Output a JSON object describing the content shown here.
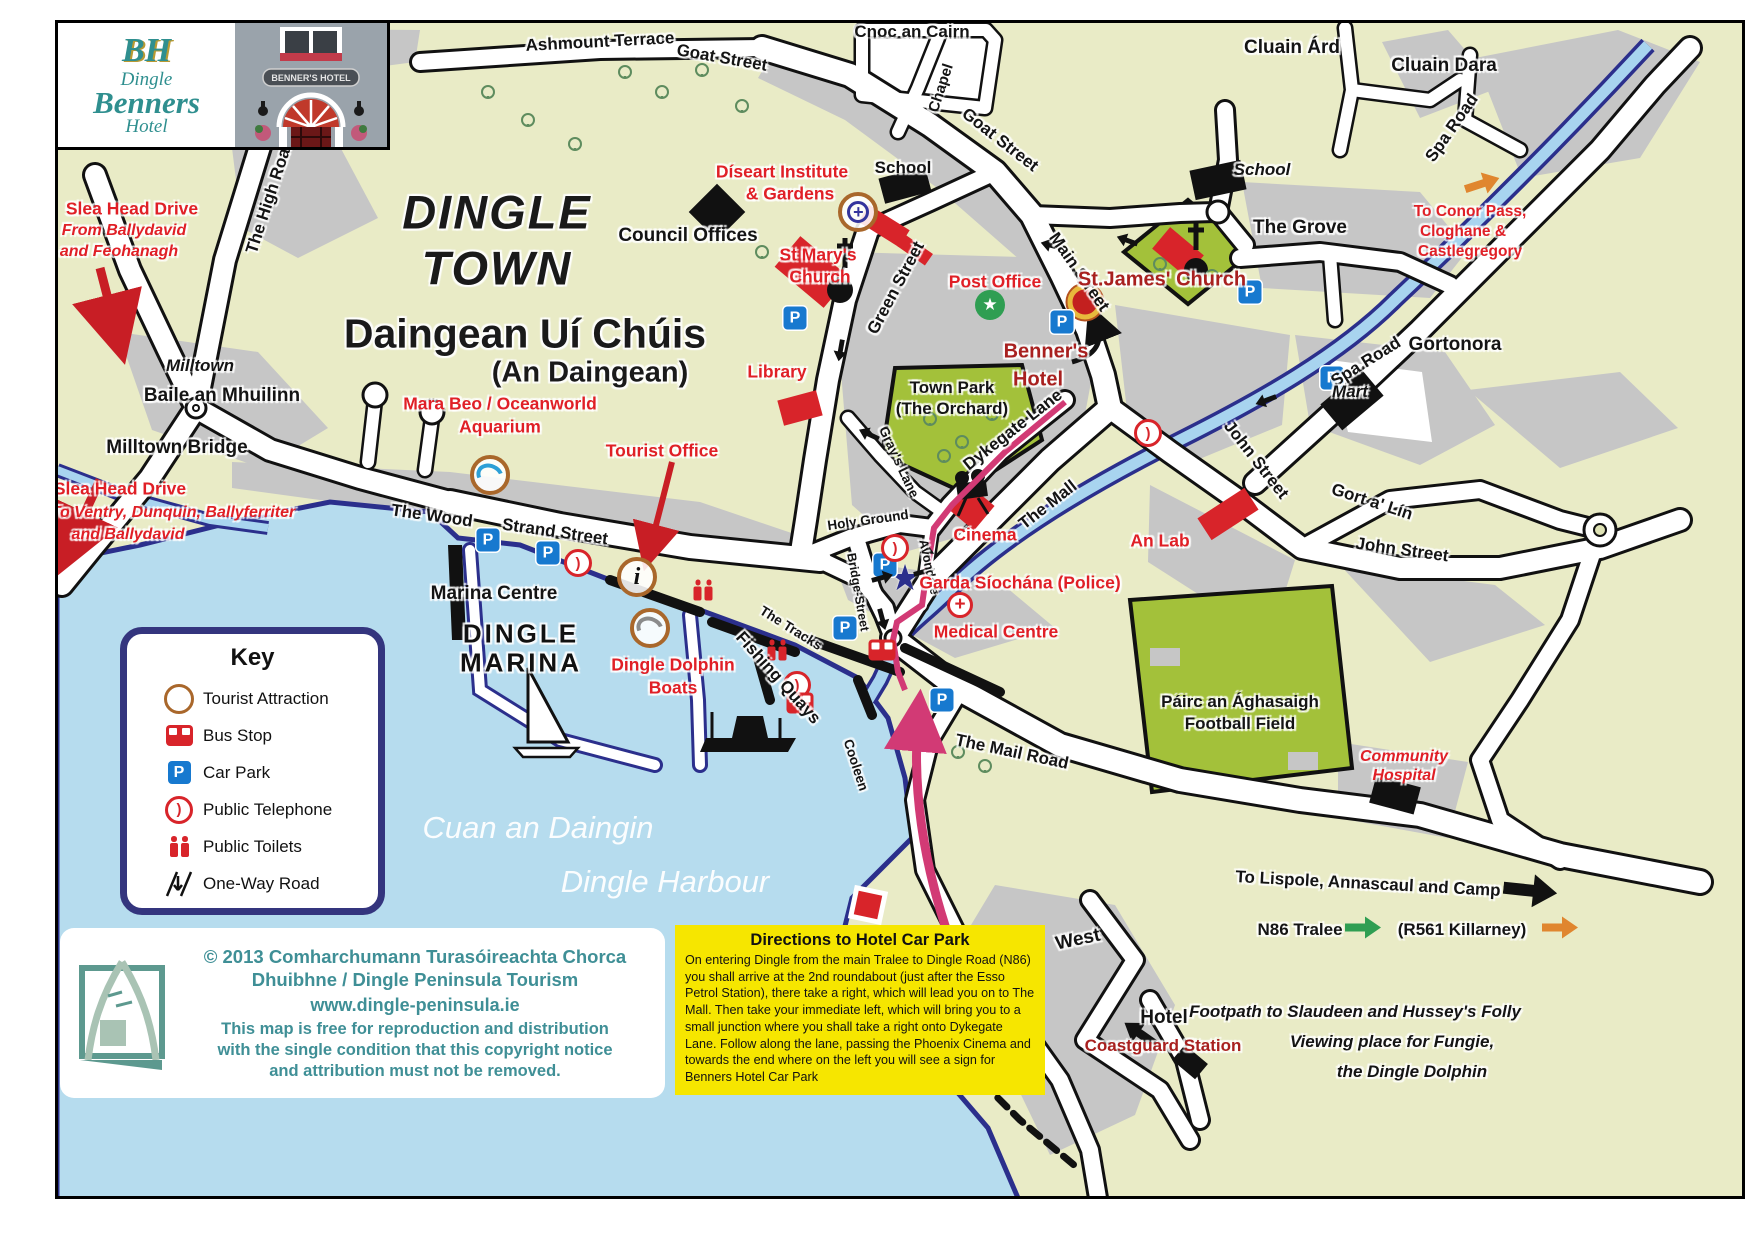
{
  "logo": {
    "monogram": "BH",
    "name_line1": "Dingle",
    "name_line2": "Benners",
    "name_line3": "Hotel",
    "photo_sign": "BENNER'S HOTEL"
  },
  "key": {
    "heading": "Key",
    "items": [
      {
        "icon": "tourist-attraction-icon",
        "label": "Tourist Attraction"
      },
      {
        "icon": "bus-stop-icon",
        "label": "Bus Stop"
      },
      {
        "icon": "car-park-icon",
        "label": "Car Park"
      },
      {
        "icon": "public-telephone-icon",
        "label": "Public Telephone"
      },
      {
        "icon": "public-toilets-icon",
        "label": "Public Toilets"
      },
      {
        "icon": "one-way-road-icon",
        "label": "One-Way Road"
      }
    ]
  },
  "copyright": {
    "line1": "© 2013 Comharchumann Turasóireachta Chorca",
    "line2": "Dhuibhne / Dingle Peninsula Tourism",
    "website": "www.dingle-peninsula.ie",
    "note1": "This map is free for reproduction and distribution",
    "note2": "with the single condition that this copyright notice",
    "note3": "and attribution must not be removed."
  },
  "directions": {
    "title": "Directions to Hotel Car Park",
    "body": "On entering Dingle from the main Tralee to Dingle Road (N86) you shall arrive at the 2nd roundabout (just after the Esso Petrol Station), there take a right, which will lead you on to The Mall. Then take your immediate left, which will bring you to a small junction where you shall take a right onto Dykegate Lane. Follow along the lane, passing the Phoenix Cinema and towards the end where on the left you will see a sign for Benners Hotel Car Park"
  },
  "colors": {
    "land": "#e9ebc6",
    "urban": "#c6c6c6",
    "water": "#b6dcee",
    "coast": "#2b2f8c",
    "road": "#ffffff",
    "park": "#a3c13a",
    "poi_red": "#e01f26",
    "dark_red": "#a8201f",
    "route_magenta": "#d23a75",
    "carpark_blue": "#1779cf",
    "attraction_ring": "#a9672b",
    "teal": "#3f8f96",
    "directions_yellow": "#f6e600",
    "arrow_green": "#2f9e52",
    "arrow_orange": "#e0862f"
  },
  "map": {
    "icon_glyphs": {
      "car-park": "P",
      "info": "i",
      "public-telephone": ")",
      "post-office-star": "★",
      "garda-star": "★",
      "medical-cross": "+",
      "celtic-cross": "+"
    },
    "labels": [
      {
        "t": "Ashmount Terrace",
        "x": 600,
        "y": 42,
        "c": "roadlg",
        "r": -3
      },
      {
        "t": "Goat Street",
        "x": 722,
        "y": 58,
        "c": "roadlg",
        "r": 10
      },
      {
        "t": "Goat Street",
        "x": 1000,
        "y": 140,
        "c": "roadlg",
        "r": 38
      },
      {
        "t": "Chapel",
        "x": 941,
        "y": 88,
        "c": "road",
        "r": -72
      },
      {
        "t": "Cnoc an Cairn",
        "x": 912,
        "y": 32,
        "c": "place"
      },
      {
        "t": "School",
        "x": 903,
        "y": 168,
        "c": "place"
      },
      {
        "t": "Council Offices",
        "x": 688,
        "y": 236,
        "c": "placelg"
      },
      {
        "t": "DINGLE",
        "x": 497,
        "y": 212,
        "c": "t1"
      },
      {
        "t": "TOWN",
        "x": 497,
        "y": 268,
        "c": "t1"
      },
      {
        "t": "Daingean Uí Chúis",
        "x": 525,
        "y": 334,
        "c": "t2"
      },
      {
        "t": "(An Daingean)",
        "x": 590,
        "y": 373,
        "c": "t3"
      },
      {
        "t": "Díseart Institute",
        "x": 782,
        "y": 172,
        "c": "redlg"
      },
      {
        "t": "& Gardens",
        "x": 790,
        "y": 194,
        "c": "redlg"
      },
      {
        "t": "St Mary's",
        "x": 818,
        "y": 255,
        "c": "redlg"
      },
      {
        "t": "Church",
        "x": 820,
        "y": 277,
        "c": "redlg"
      },
      {
        "t": "Green Street",
        "x": 896,
        "y": 288,
        "c": "roadlg",
        "r": -62
      },
      {
        "t": "Post Office",
        "x": 995,
        "y": 282,
        "c": "redlg"
      },
      {
        "t": "Main Street",
        "x": 1079,
        "y": 272,
        "c": "roadlg",
        "r": 55
      },
      {
        "t": "Benner's",
        "x": 1046,
        "y": 352,
        "c": "darkred"
      },
      {
        "t": "Hotel",
        "x": 1038,
        "y": 380,
        "c": "darkred"
      },
      {
        "t": "St.James' Church",
        "x": 1162,
        "y": 280,
        "c": "darkred"
      },
      {
        "t": "The High Road",
        "x": 270,
        "y": 196,
        "c": "roadlg",
        "r": -72
      },
      {
        "t": "Slea Head Drive",
        "x": 132,
        "y": 209,
        "c": "redlg"
      },
      {
        "t": "From Ballydavid",
        "x": 124,
        "y": 231,
        "c": "redital"
      },
      {
        "t": "and Feohanagh",
        "x": 119,
        "y": 252,
        "c": "redital"
      },
      {
        "t": "Milltown",
        "x": 200,
        "y": 366,
        "c": "italic"
      },
      {
        "t": "Baile an Mhuilinn",
        "x": 222,
        "y": 396,
        "c": "placelg"
      },
      {
        "t": "Milltown Bridge",
        "x": 177,
        "y": 448,
        "c": "placelg"
      },
      {
        "t": "Slea Head Drive",
        "x": 120,
        "y": 489,
        "c": "redlg"
      },
      {
        "t": "To Ventry, Dunquin, Ballyferriter",
        "x": 173,
        "y": 513,
        "c": "redital"
      },
      {
        "t": "and Ballydavid",
        "x": 128,
        "y": 535,
        "c": "redital"
      },
      {
        "t": "Mara Beo / Oceanworld",
        "x": 500,
        "y": 404,
        "c": "redlg"
      },
      {
        "t": "Aquarium",
        "x": 500,
        "y": 427,
        "c": "redlg"
      },
      {
        "t": "Tourist Office",
        "x": 662,
        "y": 451,
        "c": "redlg"
      },
      {
        "t": "Library",
        "x": 777,
        "y": 372,
        "c": "redlg"
      },
      {
        "t": "Town Park",
        "x": 952,
        "y": 388,
        "c": "place"
      },
      {
        "t": "(The Orchard)",
        "x": 952,
        "y": 409,
        "c": "place"
      },
      {
        "t": "Gray's Lane",
        "x": 899,
        "y": 462,
        "c": "roadsm",
        "r": 65
      },
      {
        "t": "Dykegate Lane",
        "x": 1013,
        "y": 430,
        "c": "roadlg",
        "r": -38
      },
      {
        "t": "The Mall",
        "x": 1048,
        "y": 505,
        "c": "roadlg",
        "r": -38
      },
      {
        "t": "The Wood",
        "x": 432,
        "y": 516,
        "c": "roadlg",
        "r": 8
      },
      {
        "t": "Strand Street",
        "x": 555,
        "y": 532,
        "c": "roadlg",
        "r": 8
      },
      {
        "t": "Marina Centre",
        "x": 494,
        "y": 594,
        "c": "placelg"
      },
      {
        "t": "DINGLE",
        "x": 521,
        "y": 634,
        "c": "marina"
      },
      {
        "t": "MARINA",
        "x": 521,
        "y": 663,
        "c": "marina"
      },
      {
        "t": "Holy Ground",
        "x": 868,
        "y": 520,
        "c": "roadsm",
        "r": -8
      },
      {
        "t": "Avondale",
        "x": 929,
        "y": 567,
        "c": "roadxs",
        "r": 78
      },
      {
        "t": "Bridge-Street",
        "x": 858,
        "y": 592,
        "c": "roadxs",
        "r": 80
      },
      {
        "t": "Cinema",
        "x": 985,
        "y": 535,
        "c": "redlg"
      },
      {
        "t": "Garda Síochána (Police)",
        "x": 1020,
        "y": 583,
        "c": "redlg"
      },
      {
        "t": "Medical Centre",
        "x": 996,
        "y": 632,
        "c": "redlg"
      },
      {
        "t": "An Lab",
        "x": 1160,
        "y": 541,
        "c": "redlg"
      },
      {
        "t": "The Tracks",
        "x": 791,
        "y": 628,
        "c": "roadsm",
        "r": 32
      },
      {
        "t": "Fishing Quays",
        "x": 778,
        "y": 678,
        "c": "roadlg",
        "r": 48
      },
      {
        "t": "Dingle Dolphin",
        "x": 673,
        "y": 665,
        "c": "redlg"
      },
      {
        "t": "Boats",
        "x": 673,
        "y": 688,
        "c": "redlg"
      },
      {
        "t": "Cuan an Daingin",
        "x": 538,
        "y": 828,
        "c": "water"
      },
      {
        "t": "Dingle Harbour",
        "x": 665,
        "y": 882,
        "c": "water"
      },
      {
        "t": "Cooleen",
        "x": 856,
        "y": 765,
        "c": "roadsm",
        "r": 72
      },
      {
        "t": "The Mail Road",
        "x": 1012,
        "y": 752,
        "c": "roadlg",
        "r": 12
      },
      {
        "t": "Páirc an Ághasaigh",
        "x": 1240,
        "y": 702,
        "c": "place"
      },
      {
        "t": "Football Field",
        "x": 1240,
        "y": 724,
        "c": "place"
      },
      {
        "t": "Community",
        "x": 1404,
        "y": 757,
        "c": "redital"
      },
      {
        "t": "Hospital",
        "x": 1404,
        "y": 776,
        "c": "redital"
      },
      {
        "t": "John Street",
        "x": 1256,
        "y": 460,
        "c": "roadlg",
        "r": 52
      },
      {
        "t": "Gort a' Lín",
        "x": 1372,
        "y": 502,
        "c": "roadlg",
        "r": 18
      },
      {
        "t": "John Street",
        "x": 1402,
        "y": 550,
        "c": "roadlg",
        "r": 8
      },
      {
        "t": "Spa Road",
        "x": 1366,
        "y": 362,
        "c": "roadlg",
        "r": -32
      },
      {
        "t": "Mart",
        "x": 1350,
        "y": 392,
        "c": "italic"
      },
      {
        "t": "Gortonora",
        "x": 1455,
        "y": 345,
        "c": "placelg"
      },
      {
        "t": "Cluain Árd",
        "x": 1292,
        "y": 48,
        "c": "placelg"
      },
      {
        "t": "Cluain Dara",
        "x": 1444,
        "y": 66,
        "c": "placelg"
      },
      {
        "t": "Spa Road",
        "x": 1452,
        "y": 128,
        "c": "roadlg",
        "r": -55
      },
      {
        "t": "To Conor Pass,",
        "x": 1470,
        "y": 212,
        "c": "red"
      },
      {
        "t": "Cloghane &",
        "x": 1463,
        "y": 232,
        "c": "red"
      },
      {
        "t": "Castlegregory",
        "x": 1470,
        "y": 252,
        "c": "red"
      },
      {
        "t": "The Grove",
        "x": 1300,
        "y": 228,
        "c": "placelg"
      },
      {
        "t": "School",
        "x": 1262,
        "y": 170,
        "c": "italic"
      },
      {
        "t": "To Lispole, Annascaul and Camp",
        "x": 1368,
        "y": 884,
        "c": "place",
        "r": 3
      },
      {
        "t": "N86 Tralee",
        "x": 1300,
        "y": 930,
        "c": "place"
      },
      {
        "t": "(R561 Killarney)",
        "x": 1462,
        "y": 930,
        "c": "place"
      },
      {
        "t": "West",
        "x": 1078,
        "y": 940,
        "c": "placelg",
        "r": -12
      },
      {
        "t": "Hotel",
        "x": 1164,
        "y": 1018,
        "c": "placelg"
      },
      {
        "t": "Coastguard Station",
        "x": 1163,
        "y": 1046,
        "c": "darkredsm"
      },
      {
        "t": "Footpath to Slaudeen and Hussey's Folly",
        "x": 1355,
        "y": 1012,
        "c": "italic"
      },
      {
        "t": "Viewing place for Fungie,",
        "x": 1392,
        "y": 1042,
        "c": "italic"
      },
      {
        "t": "the Dingle Dolphin",
        "x": 1412,
        "y": 1072,
        "c": "italic"
      }
    ],
    "icons": [
      {
        "t": "tourist-attraction",
        "v": "aquarium",
        "x": 490,
        "y": 475
      },
      {
        "t": "tourist-attraction",
        "v": "info",
        "x": 637,
        "y": 577
      },
      {
        "t": "tourist-attraction",
        "v": "dolphin",
        "x": 650,
        "y": 628
      },
      {
        "t": "tourist-attraction",
        "v": "celtic-cross",
        "x": 858,
        "y": 212
      },
      {
        "t": "post-office",
        "x": 990,
        "y": 305
      },
      {
        "t": "garda",
        "x": 905,
        "y": 578
      },
      {
        "t": "medical",
        "x": 960,
        "y": 605
      },
      {
        "t": "benners-marker",
        "x": 1085,
        "y": 302
      },
      {
        "t": "car-park",
        "x": 795,
        "y": 318
      },
      {
        "t": "car-park",
        "x": 1062,
        "y": 322
      },
      {
        "t": "car-park",
        "x": 1250,
        "y": 292
      },
      {
        "t": "car-park",
        "x": 1332,
        "y": 378
      },
      {
        "t": "car-park",
        "x": 488,
        "y": 540
      },
      {
        "t": "car-park",
        "x": 548,
        "y": 553
      },
      {
        "t": "car-park",
        "x": 845,
        "y": 628
      },
      {
        "t": "car-park",
        "x": 942,
        "y": 700
      },
      {
        "t": "car-park",
        "x": 885,
        "y": 565
      },
      {
        "t": "public-telephone",
        "x": 578,
        "y": 563
      },
      {
        "t": "public-telephone",
        "x": 797,
        "y": 685
      },
      {
        "t": "public-telephone",
        "x": 895,
        "y": 548
      },
      {
        "t": "public-telephone",
        "x": 1148,
        "y": 433
      },
      {
        "t": "bus-stop",
        "x": 882,
        "y": 650
      },
      {
        "t": "bus-stop",
        "x": 800,
        "y": 703
      },
      {
        "t": "public-toilets",
        "x": 703,
        "y": 590
      },
      {
        "t": "public-toilets",
        "x": 777,
        "y": 650
      },
      {
        "t": "oneway",
        "x": 838,
        "y": 350,
        "r": 100
      },
      {
        "t": "oneway",
        "x": 1052,
        "y": 243,
        "r": 195
      },
      {
        "t": "oneway",
        "x": 1128,
        "y": 238,
        "r": 200
      },
      {
        "t": "oneway",
        "x": 883,
        "y": 580,
        "r": -15
      },
      {
        "t": "oneway",
        "x": 925,
        "y": 574,
        "r": -15
      },
      {
        "t": "oneway",
        "x": 870,
        "y": 432,
        "r": 205
      },
      {
        "t": "oneway",
        "x": 1265,
        "y": 398,
        "r": 160
      },
      {
        "t": "oneway",
        "x": 880,
        "y": 620,
        "r": 75
      },
      {
        "t": "oneway",
        "x": 930,
        "y": 555,
        "r": -90
      },
      {
        "t": "block-arrow",
        "c": "green",
        "x": 1363,
        "y": 930,
        "r": 0
      },
      {
        "t": "block-arrow",
        "c": "orange",
        "x": 1560,
        "y": 930,
        "r": 0
      },
      {
        "t": "block-arrow",
        "c": "orange",
        "x": 1483,
        "y": 186,
        "r": -18
      },
      {
        "t": "block-arrow",
        "c": "black",
        "x": 1530,
        "y": 893,
        "r": 6,
        "s": 1.5
      },
      {
        "t": "block-arrow",
        "c": "black",
        "x": 1142,
        "y": 1032,
        "r": 215,
        "s": 1.1
      }
    ]
  }
}
